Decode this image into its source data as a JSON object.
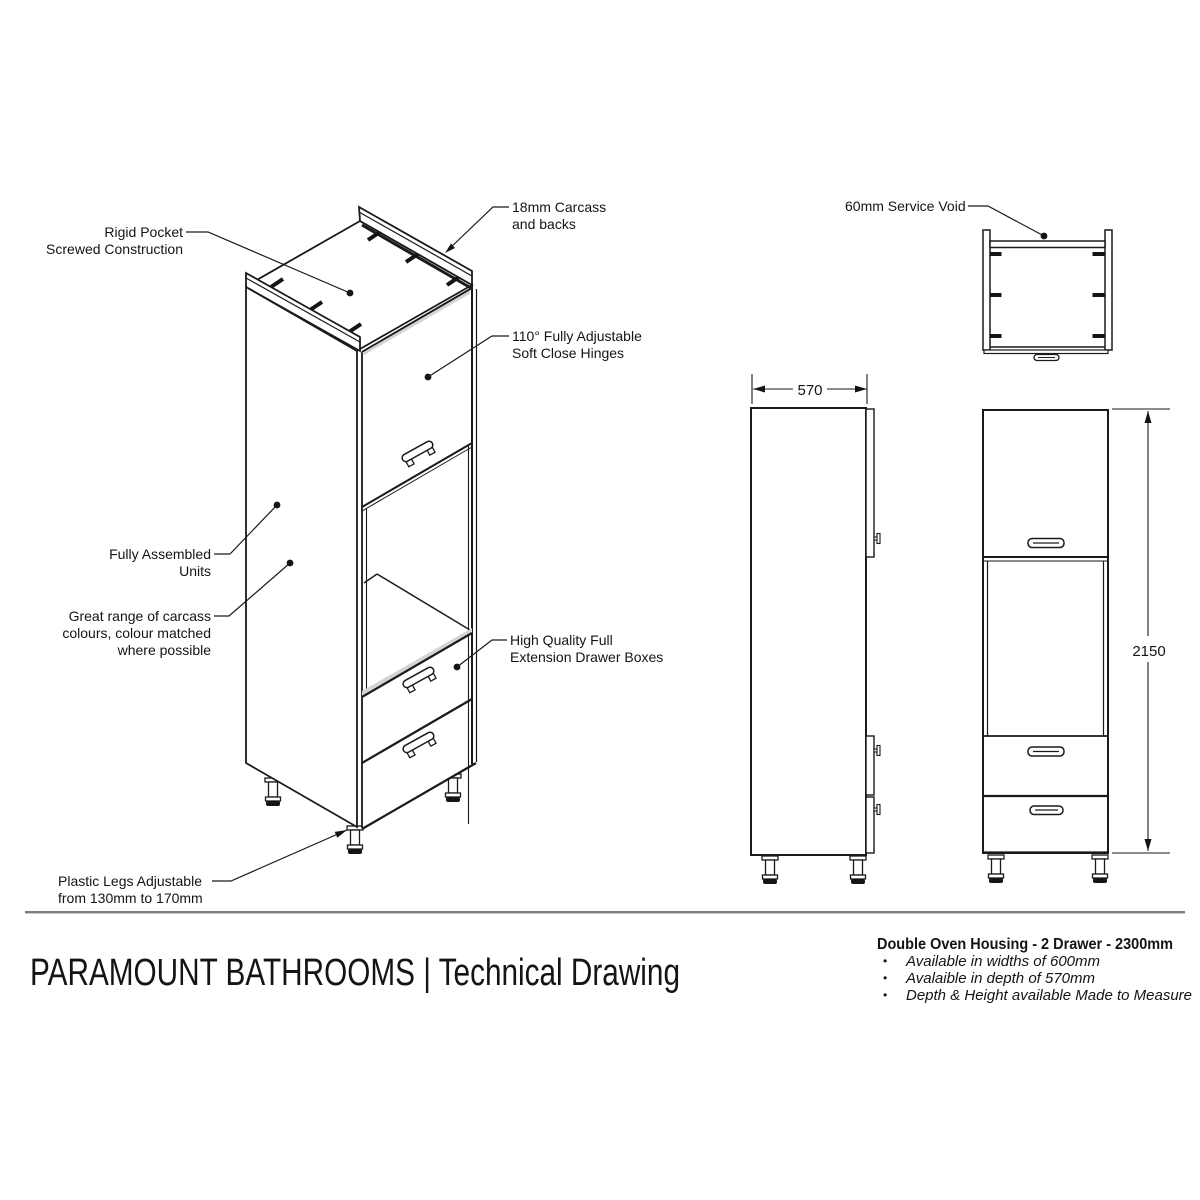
{
  "title": "PARAMOUNT BATHROOMS | Technical Drawing",
  "product": {
    "name": "Double Oven Housing - 2 Drawer - 2300mm",
    "bullet_glyph": "•",
    "bullets": [
      "Available in widths of 600mm",
      "Avalaible in depth of 570mm",
      "Depth & Height available Made to Measure"
    ]
  },
  "annotations": {
    "rigid_pocket": [
      "Rigid Pocket",
      "Screwed Construction"
    ],
    "carcass": [
      "18mm Carcass",
      "and backs"
    ],
    "hinges": [
      "110° Fully Adjustable",
      "Soft Close Hinges"
    ],
    "assembled": [
      "Fully Assembled",
      "Units"
    ],
    "colours": [
      "Great range of carcass",
      "colours, colour matched",
      "where possible"
    ],
    "drawer_boxes": [
      "High Quality Full",
      "Extension Drawer Boxes"
    ],
    "legs": [
      "Plastic Legs Adjustable",
      "from 130mm to 170mm"
    ],
    "service_void": [
      "60mm Service Void"
    ]
  },
  "dimensions": {
    "depth": "570",
    "height": "2150"
  },
  "colors": {
    "line": "#1a1a1a",
    "shade": "#d4d4d4",
    "divider": "#7d7d7d"
  }
}
